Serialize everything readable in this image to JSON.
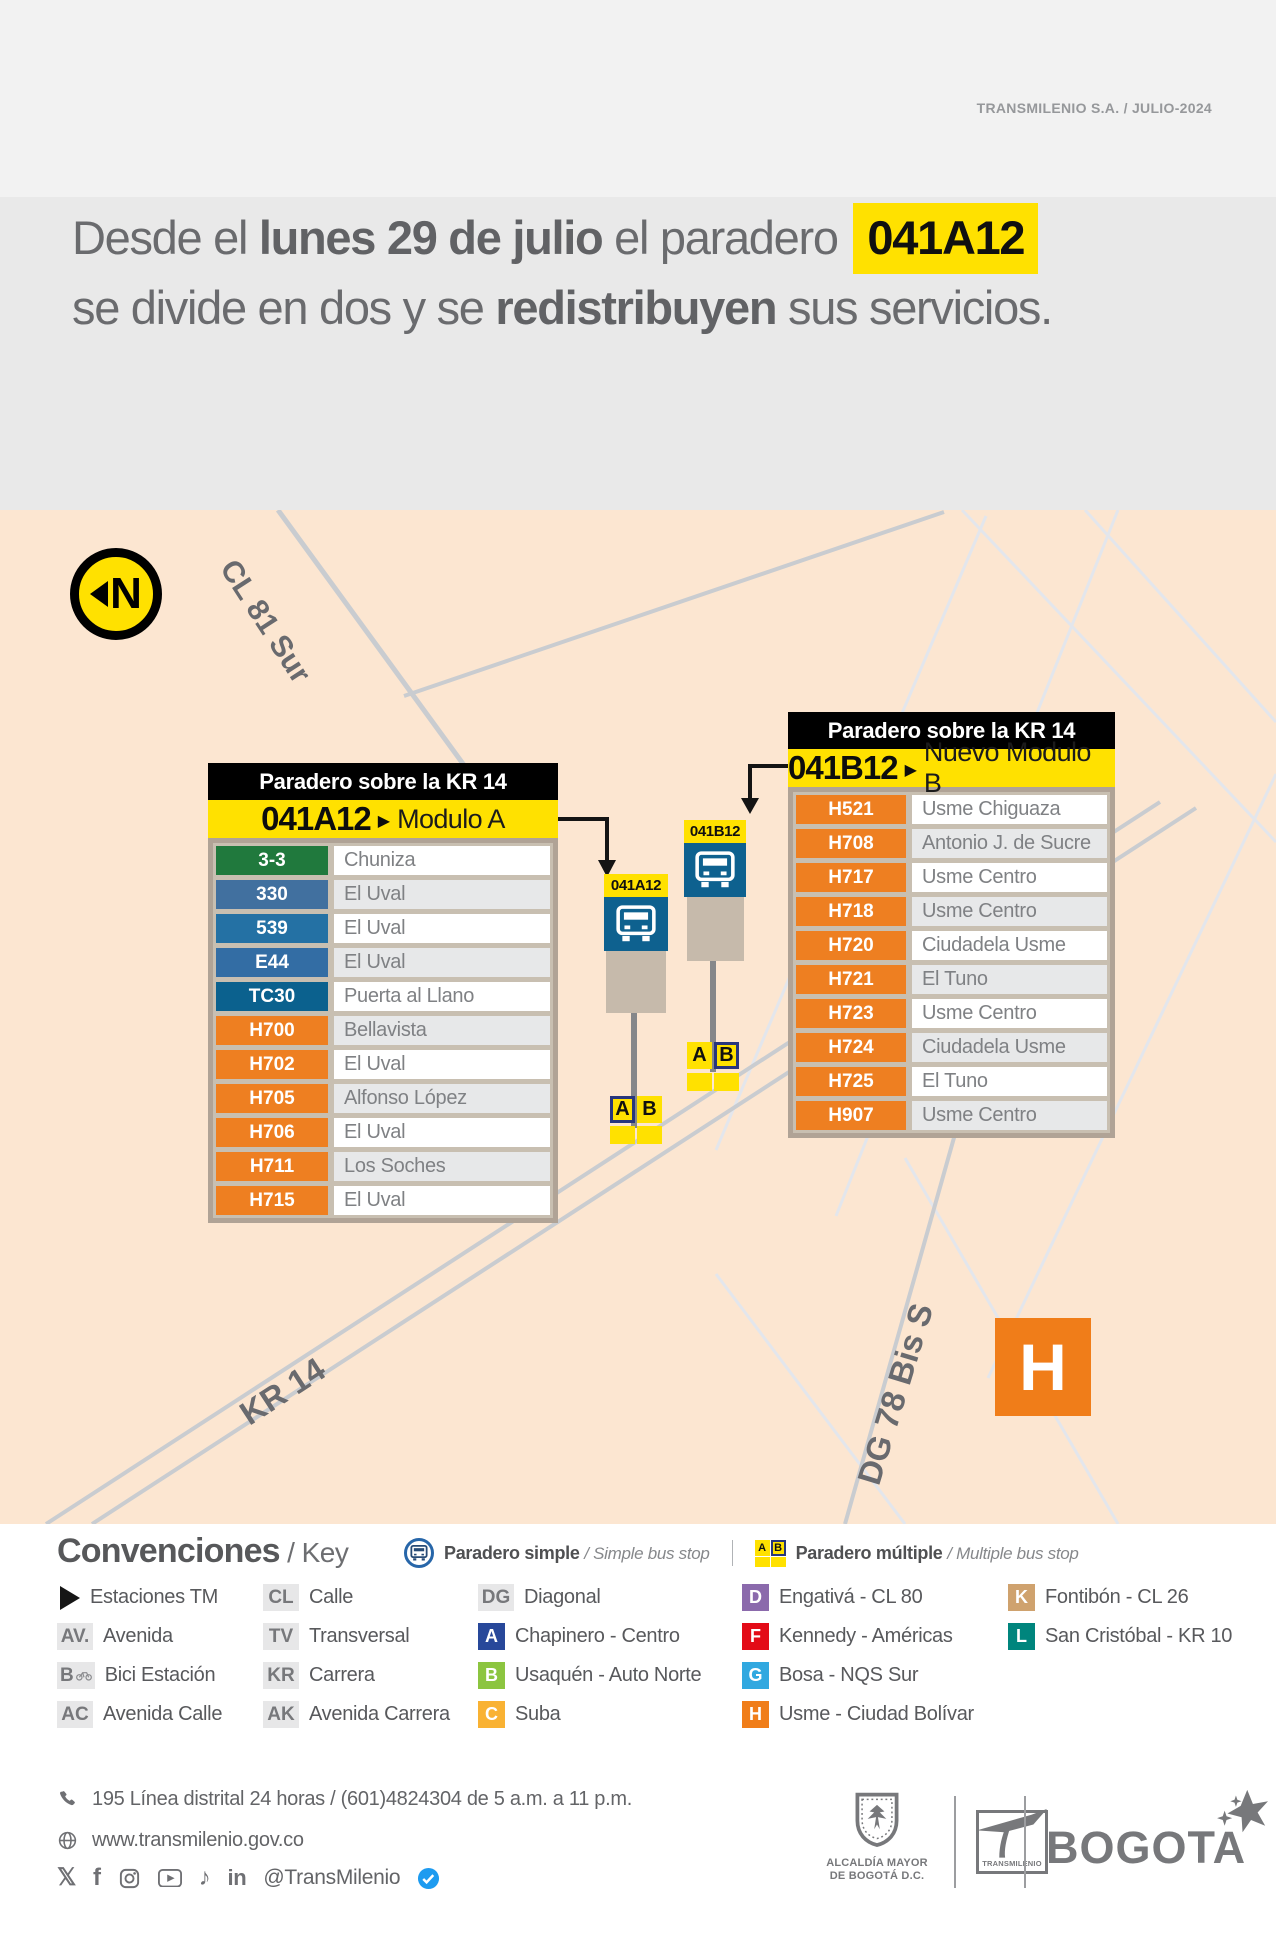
{
  "corner_note": "TRANSMILENIO S.A. / JULIO-2024",
  "headline": {
    "line1_pre": "Desde el ",
    "line1_bold": "lunes 29 de julio",
    "line1_mid": " el paradero ",
    "line1_code": "041A12",
    "line2_pre": "se divide en dos y se ",
    "line2_bold": "redistribuyen",
    "line2_post": " sus servicios."
  },
  "map": {
    "north_letter": "N",
    "street_cl81": "CL 81 Sur",
    "street_kr14": "KR 14",
    "street_dg78": "DG 78 Bis S",
    "zone_h": "H",
    "stop_a": {
      "id": "041A12",
      "letter_a": "A",
      "letter_b": "B"
    },
    "stop_b": {
      "id": "041B12",
      "letter_a": "A",
      "letter_b": "B"
    }
  },
  "table_a": {
    "header": "Paradero sobre la KR 14",
    "code": "041A12",
    "arrow": "▶",
    "module": "Modulo A",
    "routes": [
      {
        "code": "3-3",
        "dest": "Chuniza",
        "color": "#20793d"
      },
      {
        "code": "330",
        "dest": "El Uval",
        "color": "#41709f"
      },
      {
        "code": "539",
        "dest": "El Uval",
        "color": "#2471a4"
      },
      {
        "code": "E44",
        "dest": "El Uval",
        "color": "#336da4"
      },
      {
        "code": "TC30",
        "dest": "Puerta al Llano",
        "color": "#0b618e"
      },
      {
        "code": "H700",
        "dest": "Bellavista",
        "color": "#ee7f21"
      },
      {
        "code": "H702",
        "dest": "El Uval",
        "color": "#ee7f21"
      },
      {
        "code": "H705",
        "dest": "Alfonso López",
        "color": "#ee7f21"
      },
      {
        "code": "H706",
        "dest": "El Uval",
        "color": "#ee7f21"
      },
      {
        "code": "H711",
        "dest": "Los Soches",
        "color": "#ee7f21"
      },
      {
        "code": "H715",
        "dest": "El Uval",
        "color": "#ee7f21"
      }
    ]
  },
  "table_b": {
    "header": "Paradero sobre la KR 14",
    "code": "041B12",
    "arrow": "▶",
    "module": "Nuevo Modulo B",
    "routes": [
      {
        "code": "H521",
        "dest": "Usme Chiguaza",
        "color": "#ee7f21"
      },
      {
        "code": "H708",
        "dest": "Antonio J. de Sucre",
        "color": "#ee7f21"
      },
      {
        "code": "H717",
        "dest": "Usme Centro",
        "color": "#ee7f21"
      },
      {
        "code": "H718",
        "dest": "Usme Centro",
        "color": "#ee7f21"
      },
      {
        "code": "H720",
        "dest": "Ciudadela Usme",
        "color": "#ee7f21"
      },
      {
        "code": "H721",
        "dest": "El Tuno",
        "color": "#ee7f21"
      },
      {
        "code": "H723",
        "dest": "Usme Centro",
        "color": "#ee7f21"
      },
      {
        "code": "H724",
        "dest": "Ciudadela Usme",
        "color": "#ee7f21"
      },
      {
        "code": "H725",
        "dest": "El Tuno",
        "color": "#ee7f21"
      },
      {
        "code": "H907",
        "dest": "Usme Centro",
        "color": "#ee7f21"
      }
    ]
  },
  "legend": {
    "title": "Convenciones",
    "title_suffix": " / Key",
    "simple_es": "Paradero simple ",
    "simple_en": "/ Simple bus stop",
    "multiple_es": "Paradero múltiple ",
    "multiple_en": "/ Multiple bus stop",
    "icon_a": "A",
    "icon_b": "B",
    "col1": [
      {
        "label": "Estaciones TM"
      },
      {
        "abbr": "AV.",
        "label": "Avenida"
      },
      {
        "abbr": "B",
        "label": "Bici Estación"
      },
      {
        "abbr": "AC",
        "label": "Avenida Calle"
      }
    ],
    "col2": [
      {
        "abbr": "CL",
        "label": "Calle"
      },
      {
        "abbr": "TV",
        "label": "Transversal"
      },
      {
        "abbr": "KR",
        "label": "Carrera"
      },
      {
        "abbr": "AK",
        "label": "Avenida Carrera"
      }
    ],
    "col3": [
      {
        "abbr": "DG",
        "label": "Diagonal"
      },
      {
        "zone": "A",
        "color": "#28489a",
        "label": "Chapinero - Centro"
      },
      {
        "zone": "B",
        "color": "#8cc540",
        "label": "Usaquén - Auto Norte"
      },
      {
        "zone": "C",
        "color": "#f9b233",
        "label": "Suba"
      }
    ],
    "col4": [
      {
        "zone": "D",
        "color": "#8b6aac",
        "label": "Engativá - CL 80"
      },
      {
        "zone": "F",
        "color": "#e30b17",
        "label": "Kennedy - Américas"
      },
      {
        "zone": "G",
        "color": "#31a8e0",
        "label": "Bosa - NQS Sur"
      },
      {
        "zone": "H",
        "color": "#f07d19",
        "label": "Usme - Ciudad Bolívar"
      }
    ],
    "col5": [
      {
        "zone": "K",
        "color": "#cfa26e",
        "label": "Fontibón - CL 26"
      },
      {
        "zone": "L",
        "color": "#00857d",
        "label": "San Cristóbal - KR 10"
      }
    ]
  },
  "footer": {
    "phone": "195 Línea distrital 24 horas / (601)4824304 de 5 a.m. a 11 p.m.",
    "website": "www.transmilenio.gov.co",
    "handle": "@TransMilenio",
    "alcaldia_1": "ALCALDÍA MAYOR",
    "alcaldia_2": "DE BOGOTÁ D.C.",
    "tm_logo": "TRANSMILENIO",
    "bogota": "BOGOTA"
  }
}
